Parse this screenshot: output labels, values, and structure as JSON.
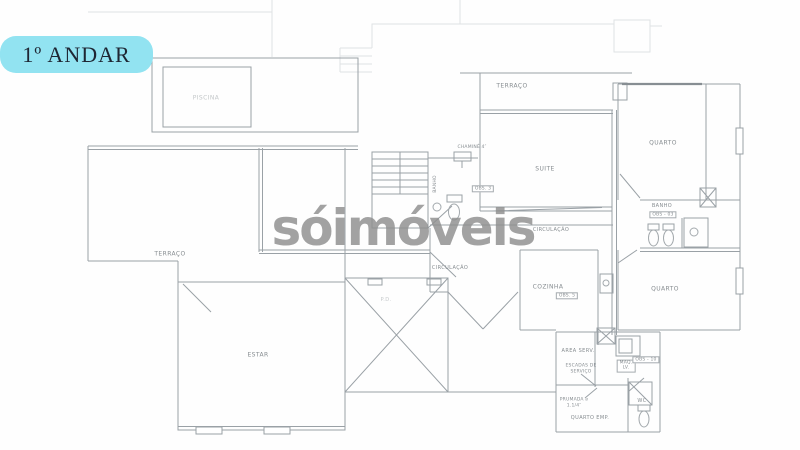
{
  "badge": {
    "text": "1º ANDAR"
  },
  "watermark": {
    "text": "sóimóveis"
  },
  "colors": {
    "badge_bg": "#92e3f1",
    "badge_text": "#1e2633",
    "watermark": "#8f8f8f",
    "line": "#9aa1a6"
  },
  "plan": {
    "labels": {
      "piscina": {
        "text": "PISCINA"
      },
      "terraco_top": {
        "text": "TERRAÇO"
      },
      "suite": {
        "text": "SUITE"
      },
      "quarto_1": {
        "text": "QUARTO"
      },
      "banho_1": {
        "text": "BANHO"
      },
      "obs_banho": {
        "text": "OBS - 03"
      },
      "quarto_2": {
        "text": "QUARTO"
      },
      "circulacao_1": {
        "text": "CIRCULAÇÃO"
      },
      "circulacao_2": {
        "text": "CIRCULAÇÃO"
      },
      "cozinha": {
        "text": "COZINHA"
      },
      "obs_cozinha": {
        "text": "OBS. 5"
      },
      "banho_2": {
        "text": "BANHO"
      },
      "chamine": {
        "text": "CHAMINÉ 4″"
      },
      "obs_3": {
        "text": "OBS. 3"
      },
      "terraco_left": {
        "text": "TERRAÇO"
      },
      "estar": {
        "text": "ESTAR"
      },
      "pd": {
        "text": "P.D."
      },
      "area_serv": {
        "text": "AREA SERV."
      },
      "escadas": {
        "text": "ESCADAS DE\nSERVIÇO"
      },
      "prumada": {
        "text": "PRUMADA ⌀\n1.1/4″"
      },
      "quarto_emp": {
        "text": "QUARTO EMP."
      },
      "wc": {
        "text": "WC"
      },
      "maq": {
        "text": "MAQ.\nLV."
      },
      "obs_10": {
        "text": "OBS - 10"
      }
    }
  }
}
